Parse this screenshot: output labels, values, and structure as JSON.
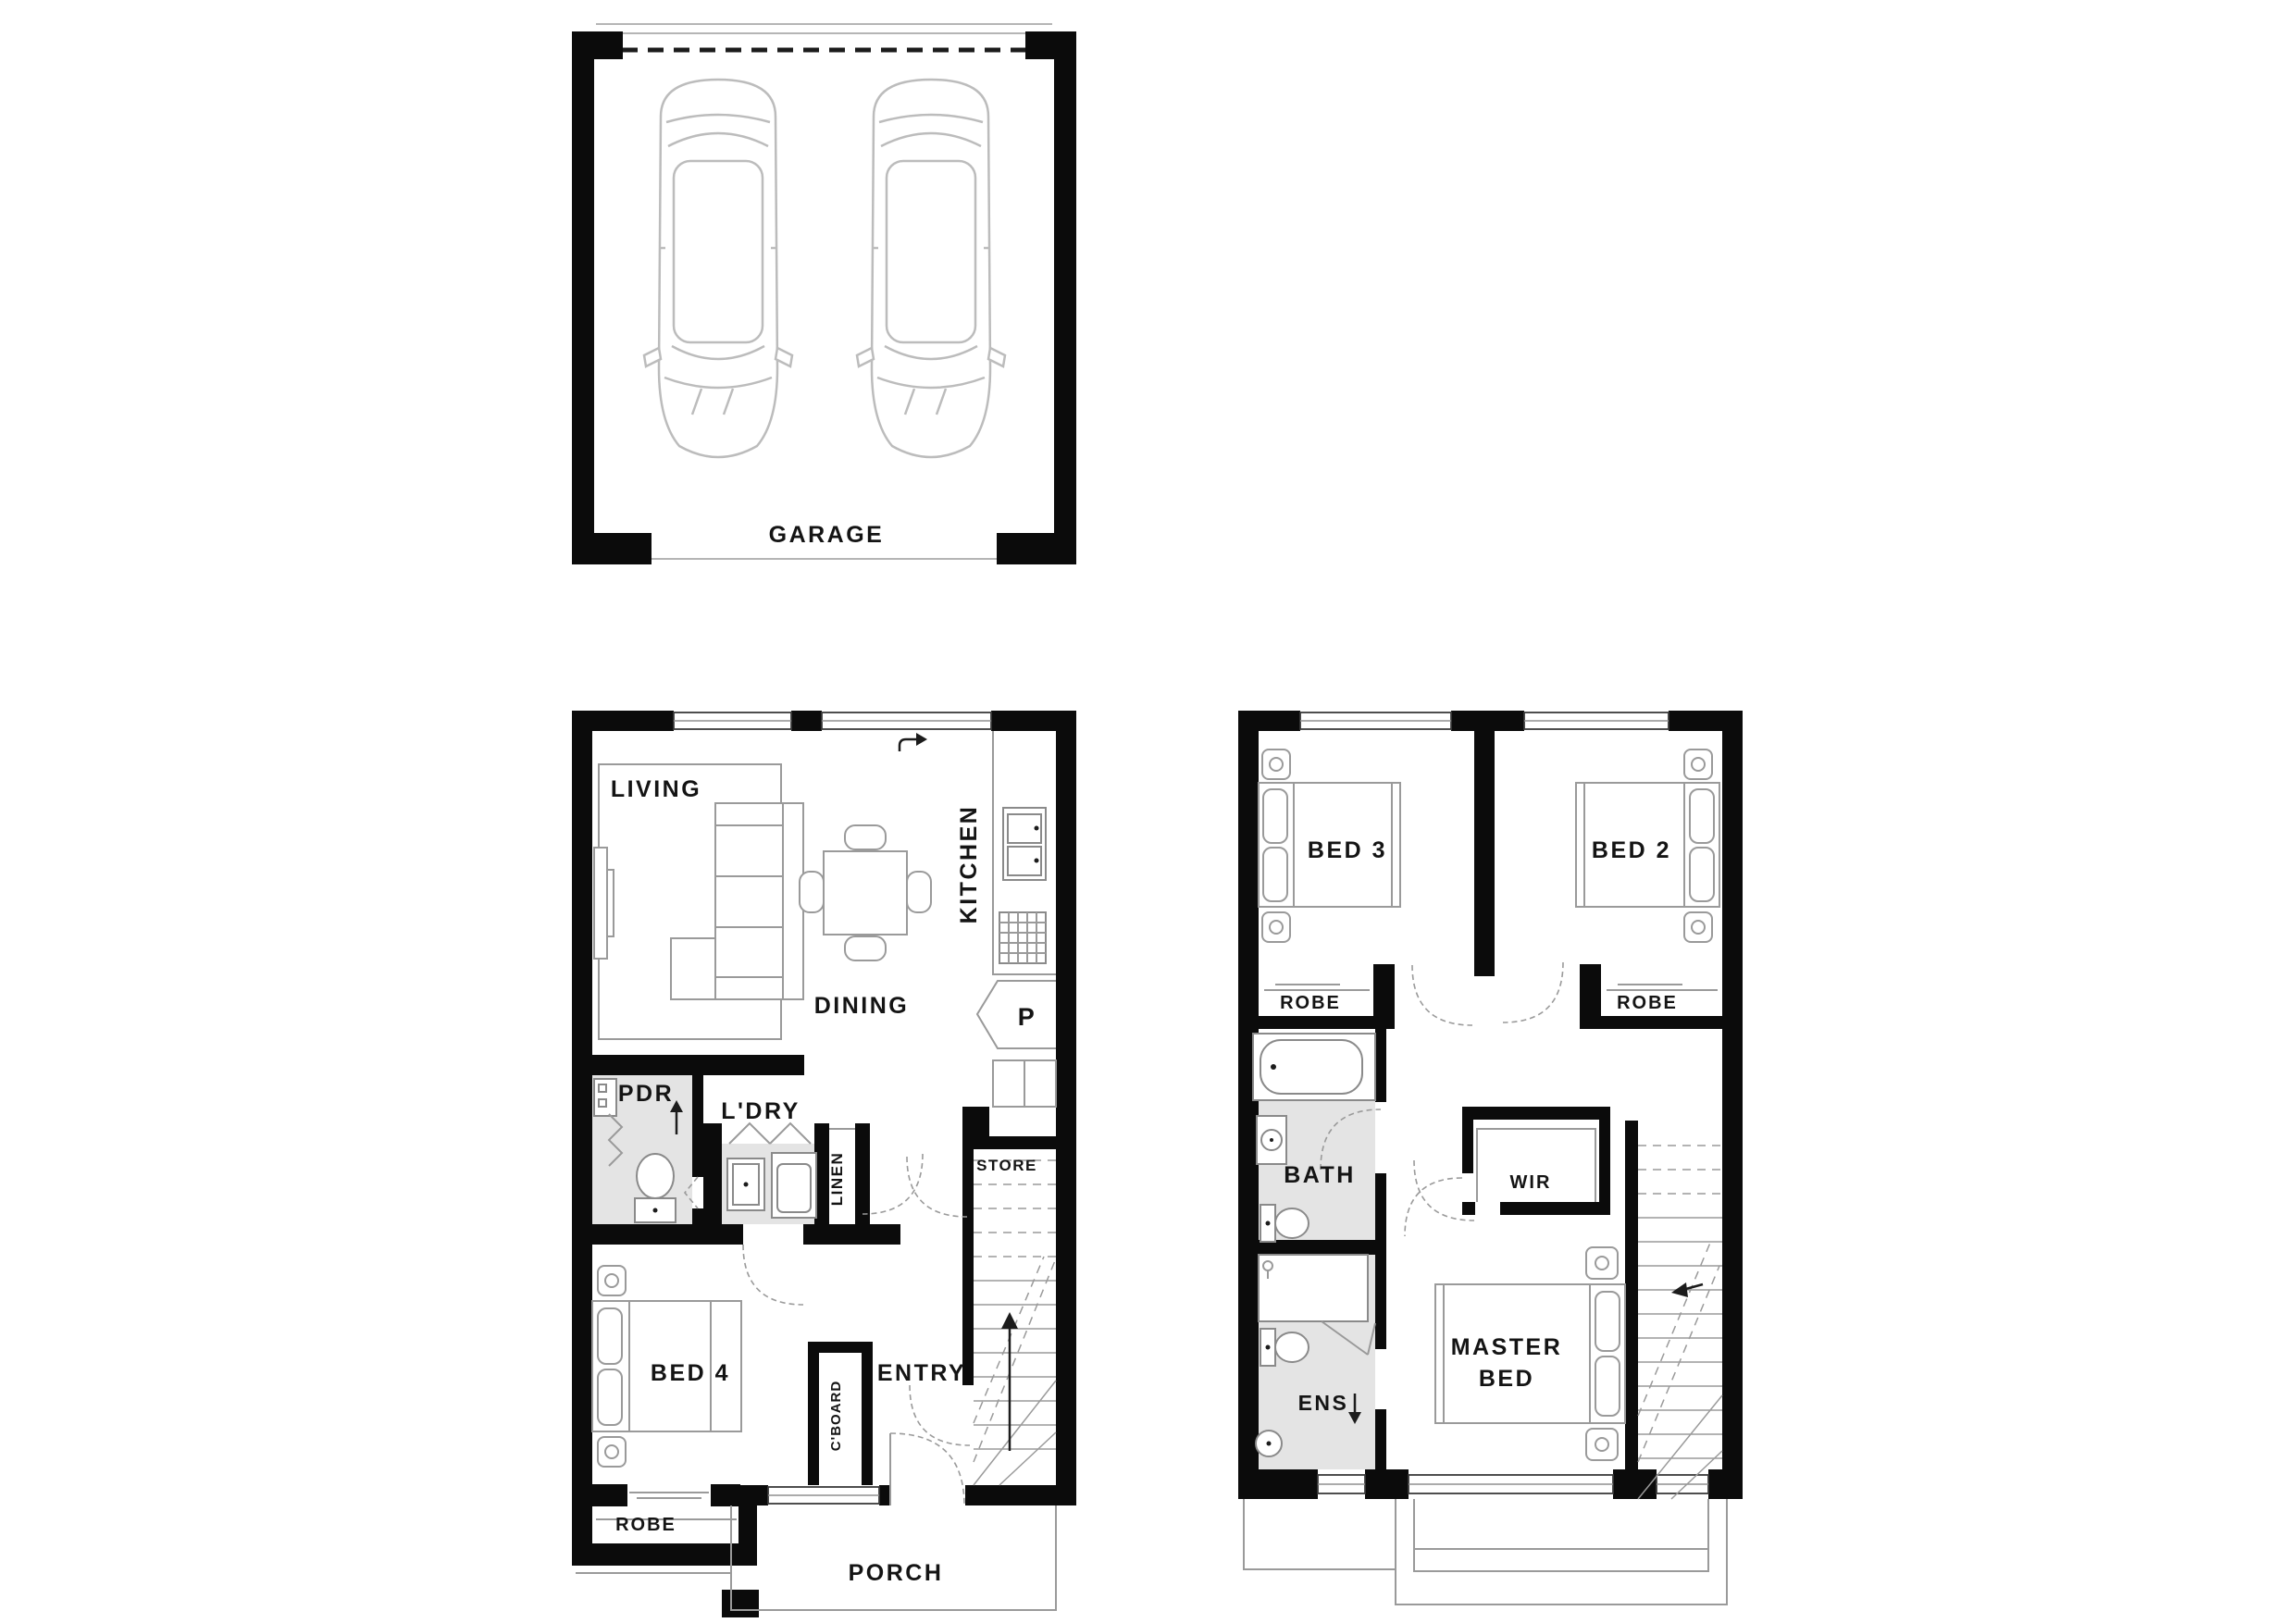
{
  "theme": {
    "background": "#ffffff",
    "wall_color": "#0b0b0b",
    "furniture_color": "#9a9a9a",
    "car_color": "#bcbcbc",
    "wet_area_color": "#e4e4e4",
    "text_color": "#141414"
  },
  "garage": {
    "label": "GARAGE"
  },
  "ground_floor": {
    "living": "LIVING",
    "dining": "DINING",
    "kitchen": "KITCHEN",
    "pantry": "P",
    "powder": "PDR",
    "laundry": "L'DRY",
    "linen": "LINEN",
    "store": "STORE",
    "bed4": "BED 4",
    "robe": "ROBE",
    "cupboard": "C'BOARD",
    "entry": "ENTRY",
    "porch": "PORCH"
  },
  "first_floor": {
    "bed3": "BED 3",
    "bed2": "BED 2",
    "robe_left": "ROBE",
    "robe_right": "ROBE",
    "bath": "BATH",
    "wir": "WIR",
    "ens": "ENS",
    "master_line1": "MASTER",
    "master_line2": "BED"
  }
}
